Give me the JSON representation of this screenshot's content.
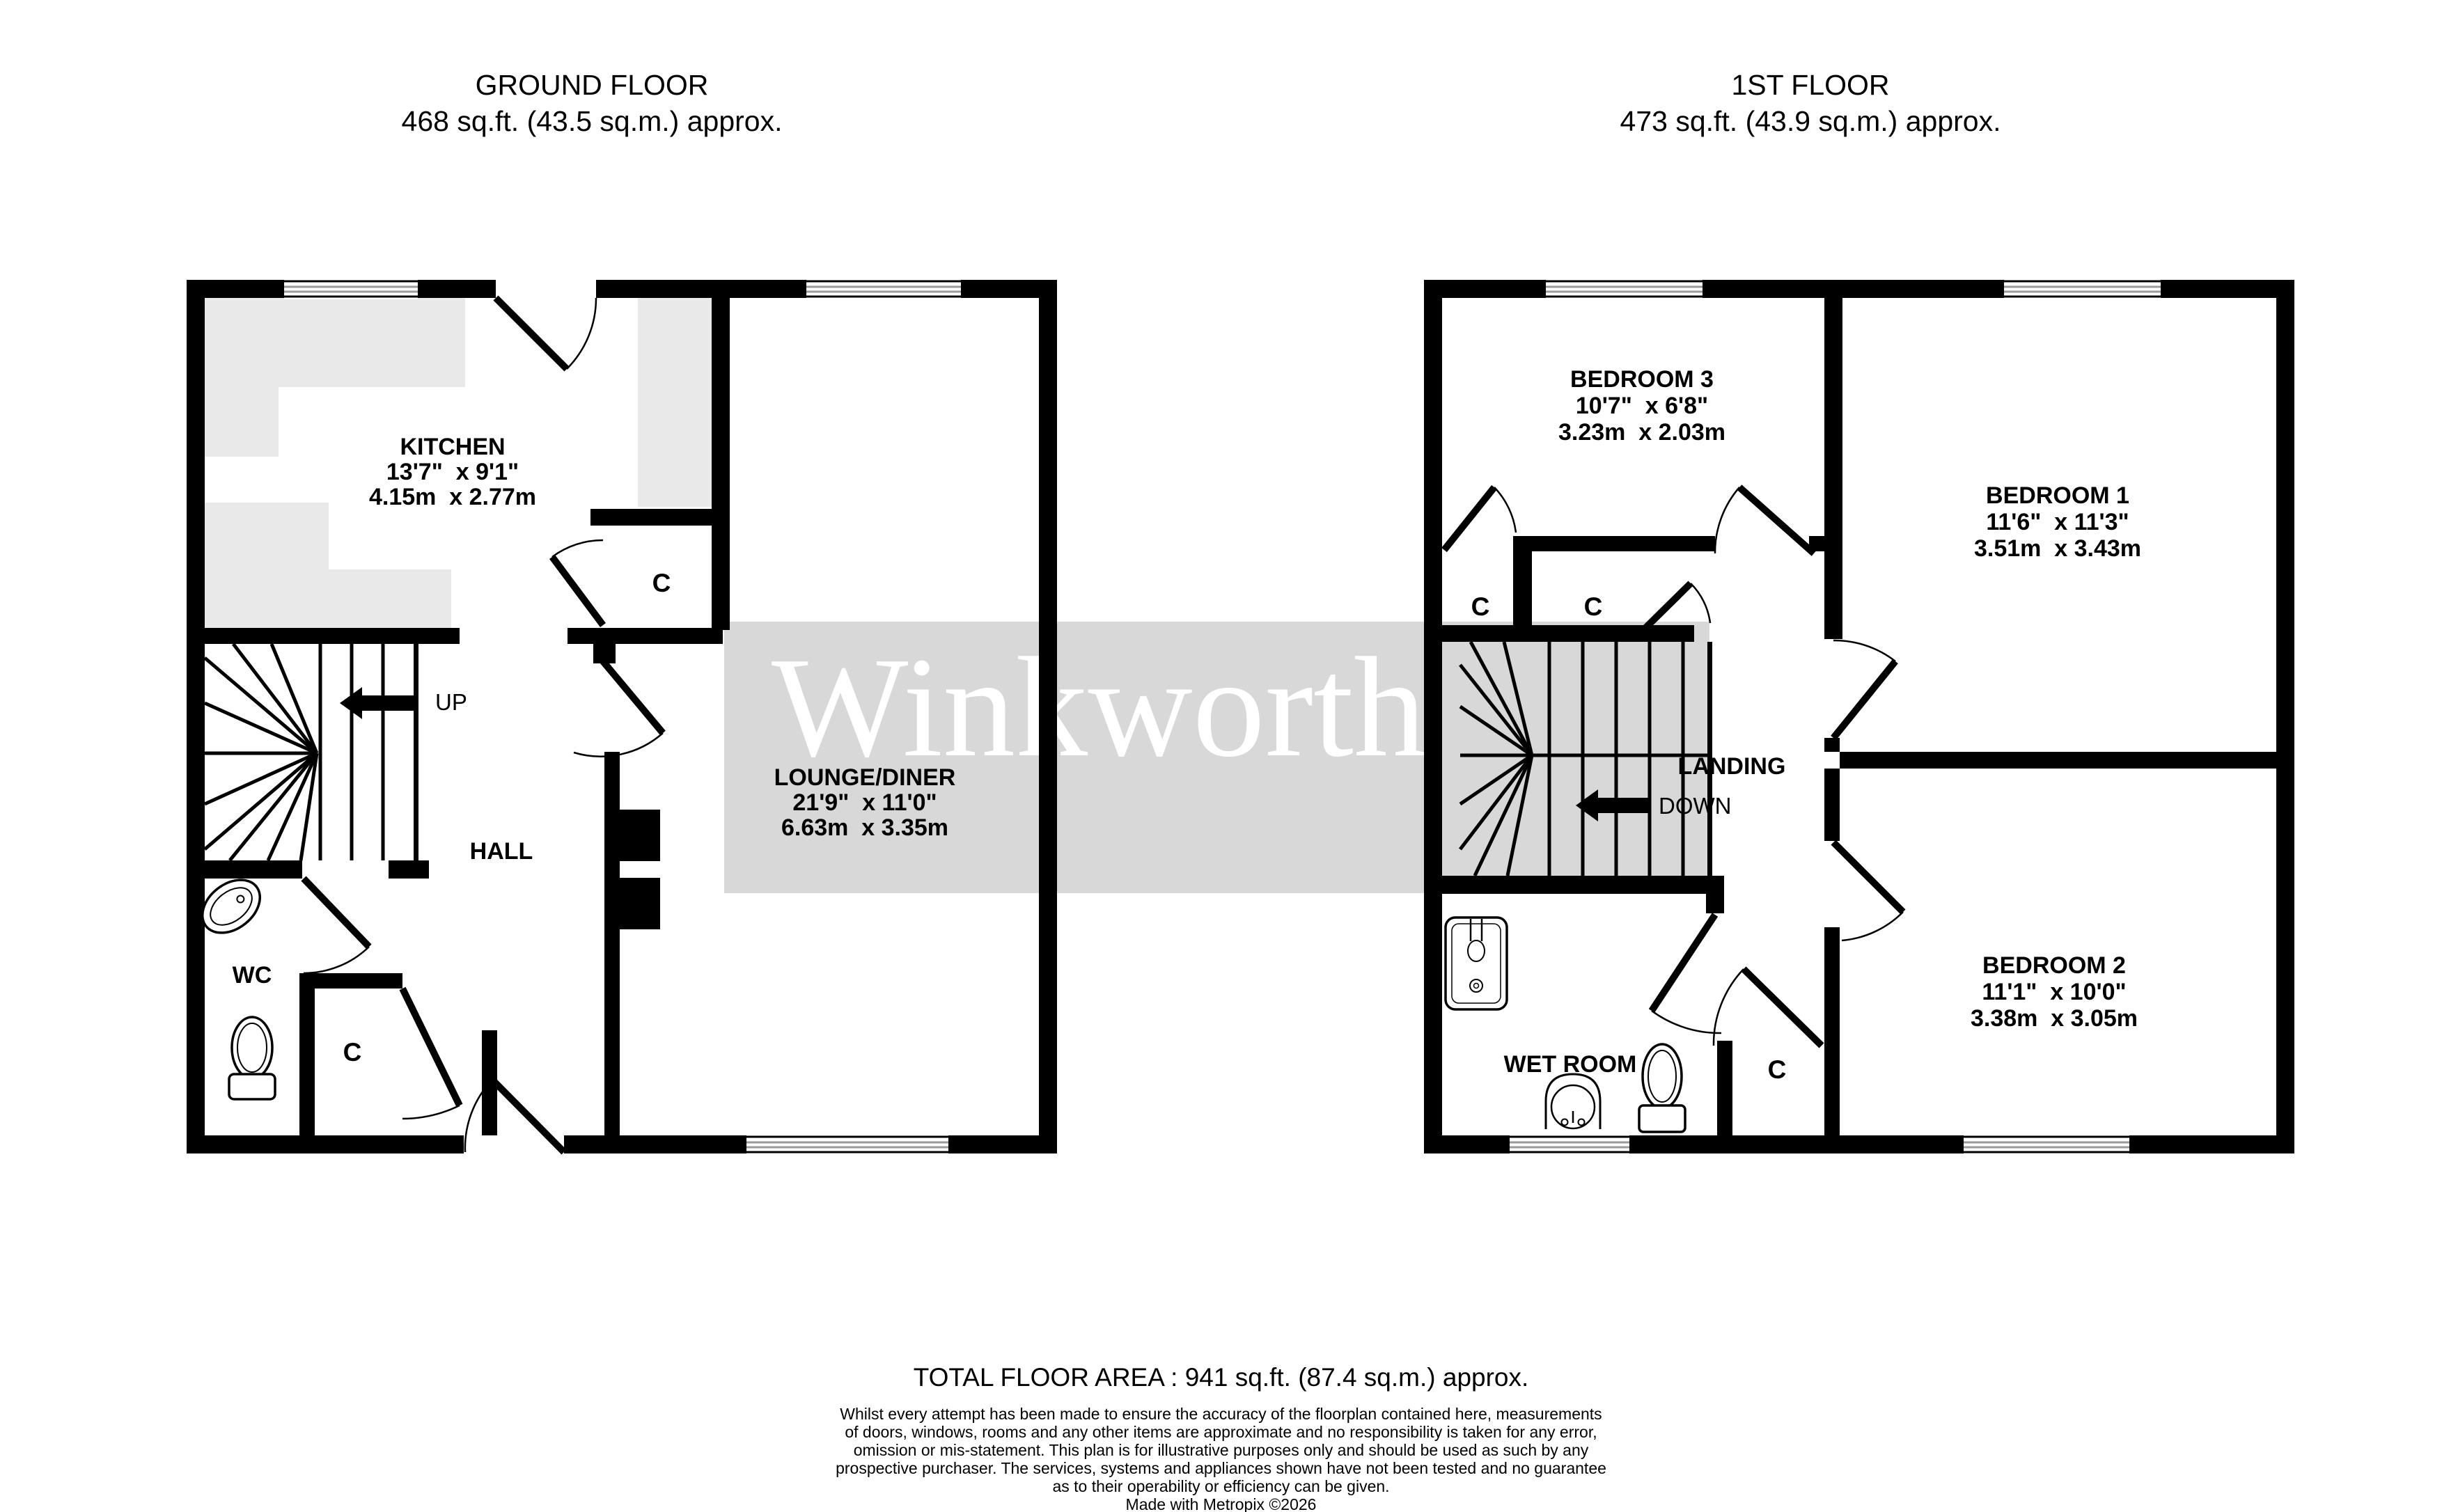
{
  "watermark": {
    "text": "Winkworth",
    "band_color": "#d8d8d8",
    "text_color": "#ffffff"
  },
  "ground": {
    "title": "GROUND FLOOR",
    "area": "468 sq.ft. (43.5 sq.m.) approx.",
    "rooms": {
      "kitchen": {
        "name": "KITCHEN",
        "dim_ft": "13'7\"  x 9'1\"",
        "dim_m": "4.15m  x 2.77m"
      },
      "lounge": {
        "name": "LOUNGE/DINER",
        "dim_ft": "21'9\"  x 11'0\"",
        "dim_m": "6.63m  x 3.35m"
      },
      "hall": {
        "name": "HALL"
      },
      "wc": {
        "name": "WC"
      }
    },
    "closets": [
      "C",
      "C"
    ],
    "stairs_label": "UP"
  },
  "first": {
    "title": "1ST FLOOR",
    "area": "473 sq.ft. (43.9 sq.m.) approx.",
    "rooms": {
      "bedroom1": {
        "name": "BEDROOM 1",
        "dim_ft": "11'6\"  x 11'3\"",
        "dim_m": "3.51m  x 3.43m"
      },
      "bedroom2": {
        "name": "BEDROOM 2",
        "dim_ft": "11'1\"  x 10'0\"",
        "dim_m": "3.38m  x 3.05m"
      },
      "bedroom3": {
        "name": "BEDROOM 3",
        "dim_ft": "10'7\"  x 6'8\"",
        "dim_m": "3.23m  x 2.03m"
      },
      "landing": {
        "name": "LANDING"
      },
      "wet_room": {
        "name": "WET ROOM"
      }
    },
    "closets": [
      "C",
      "C",
      "C"
    ],
    "stairs_label": "DOWN"
  },
  "footer": {
    "total_area": "TOTAL FLOOR AREA : 941 sq.ft. (87.4 sq.m.) approx.",
    "disclaimer_lines": [
      "Whilst every attempt has been made to ensure the accuracy of the floorplan contained here, measurements",
      "of doors, windows, rooms and any other items are approximate and no responsibility is taken for any error,",
      "omission or mis-statement. This plan is for illustrative purposes only and should be used as such by any",
      "prospective purchaser. The services, systems and appliances shown have not been tested and no guarantee",
      "as to their operability or efficiency can be given."
    ],
    "credit": "Made with Metropix ©2026"
  }
}
